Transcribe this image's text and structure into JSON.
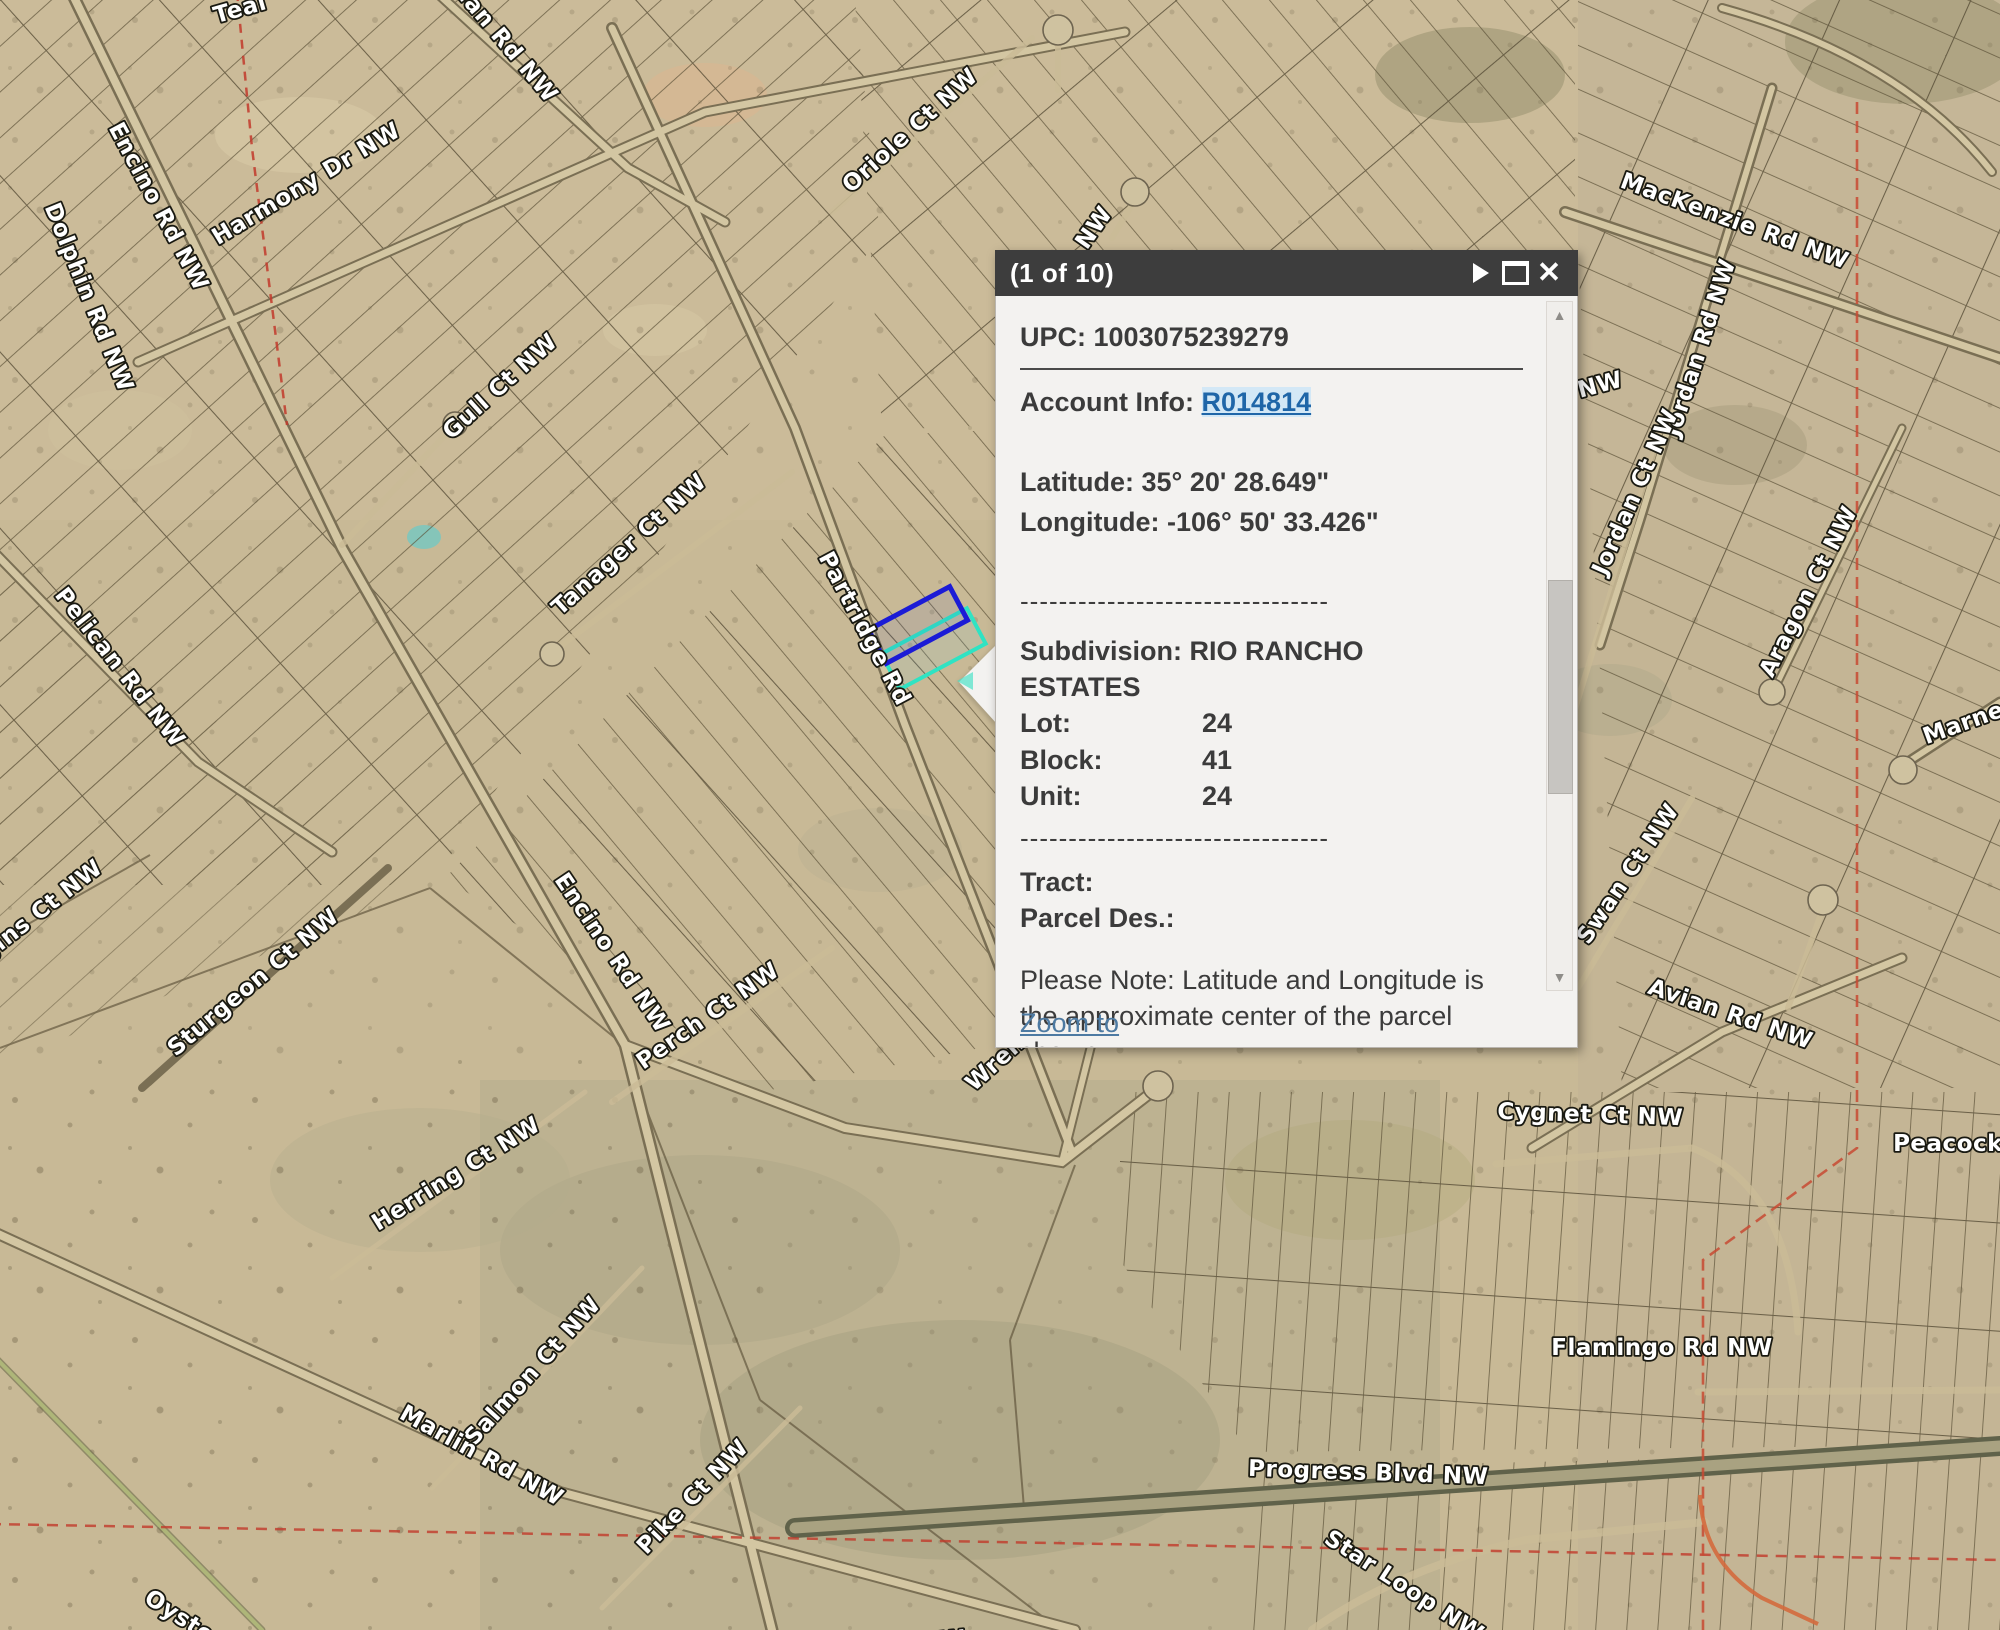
{
  "popup": {
    "title": "(1 of 10)",
    "icons": {
      "next_glyph": "▶",
      "close_glyph": "✕",
      "scroll_up_glyph": "▲",
      "scroll_down_glyph": "▼"
    },
    "fields": {
      "upc_label": "UPC:",
      "upc_value": "1003075239279",
      "account_label": "Account Info:",
      "account_link": "R014814",
      "latitude_label": "Latitude:",
      "latitude_value": "35° 20' 28.649\"",
      "longitude_label": "Longitude:",
      "longitude_value": "-106° 50' 33.426\"",
      "separator": "--------------------------------",
      "subdivision_label": "Subdivision:",
      "subdivision_value": "RIO RANCHO ESTATES",
      "lot_label": "Lot:",
      "lot_value": "24",
      "block_label": "Block:",
      "block_value": "41",
      "unit_label": "Unit:",
      "unit_value": "24",
      "separator2": "--------------------------------",
      "tract_label": "Tract:",
      "tract_value": "",
      "parcel_des_label": "Parcel Des.:",
      "parcel_des_value": "",
      "note": "Please Note: Latitude and Longitude is the approximate center of the parcel shown",
      "zoom_to": "Zoom to"
    },
    "colors": {
      "header_bg": "#3d3d3d",
      "body_bg": "#f3f2f0",
      "link": "#1f66a8"
    }
  },
  "map": {
    "selection": {
      "parcel_outline_blue": "#1b1bd6",
      "parcel_outline_teal": "#2fe3c3",
      "boundary_red": "#c2392b"
    },
    "labels": [
      {
        "text": "Teal",
        "x": 242,
        "y": 16,
        "rot": -16
      },
      {
        "text": "Avian Rd NW",
        "x": 492,
        "y": 38,
        "rot": 50
      },
      {
        "text": "Oriole Ct NW",
        "x": 915,
        "y": 136,
        "rot": -42
      },
      {
        "text": "NW",
        "x": 1100,
        "y": 232,
        "rot": -55
      },
      {
        "text": "Harmony Dr NW",
        "x": 310,
        "y": 190,
        "rot": -31
      },
      {
        "text": "Encino Rd NW",
        "x": 152,
        "y": 210,
        "rot": 62
      },
      {
        "text": "Dolphin Rd NW",
        "x": 82,
        "y": 300,
        "rot": 68
      },
      {
        "text": "MacKenzie Rd NW",
        "x": 1732,
        "y": 228,
        "rot": 20
      },
      {
        "text": "Jordan Rd NW",
        "x": 1707,
        "y": 350,
        "rot": -72
      },
      {
        "text": "Jordan Ct NW",
        "x": 1642,
        "y": 495,
        "rot": -66
      },
      {
        "text": "NW",
        "x": 1602,
        "y": 392,
        "rot": -15
      },
      {
        "text": "Aragon Ct NW",
        "x": 1815,
        "y": 595,
        "rot": -63
      },
      {
        "text": "Marne",
        "x": 1966,
        "y": 730,
        "rot": -20
      },
      {
        "text": "Gull Ct NW",
        "x": 505,
        "y": 392,
        "rot": -42
      },
      {
        "text": "Tanager Ct NW",
        "x": 634,
        "y": 550,
        "rot": -42
      },
      {
        "text": "Partridge Rd",
        "x": 858,
        "y": 632,
        "rot": 62
      },
      {
        "text": "Pelican Rd NW",
        "x": 114,
        "y": 672,
        "rot": 52
      },
      {
        "text": "Higgins Ct NW",
        "x": 28,
        "y": 930,
        "rot": -38
      },
      {
        "text": "Sturgeon Ct NW",
        "x": 258,
        "y": 988,
        "rot": -40
      },
      {
        "text": "Encino Rd NW",
        "x": 606,
        "y": 957,
        "rot": 56
      },
      {
        "text": "Perch Ct NW",
        "x": 712,
        "y": 1022,
        "rot": -35
      },
      {
        "text": "Wren Ct",
        "x": 1014,
        "y": 1056,
        "rot": -42
      },
      {
        "text": "Herring Ct NW",
        "x": 460,
        "y": 1180,
        "rot": -32
      },
      {
        "text": "Salmon Ct NW",
        "x": 538,
        "y": 1376,
        "rot": -48
      },
      {
        "text": "Marlin Rd NW",
        "x": 478,
        "y": 1462,
        "rot": 29
      },
      {
        "text": "Pike Ct NW",
        "x": 698,
        "y": 1502,
        "rot": -46
      },
      {
        "text": "Swan Ct NW",
        "x": 1634,
        "y": 878,
        "rot": -56
      },
      {
        "text": "Avian Rd NW",
        "x": 1728,
        "y": 1021,
        "rot": 19
      },
      {
        "text": "Cygnet Ct NW",
        "x": 1590,
        "y": 1122,
        "rot": 2
      },
      {
        "text": "Peacock",
        "x": 1948,
        "y": 1151,
        "rot": 0
      },
      {
        "text": "Flamingo Rd NW",
        "x": 1662,
        "y": 1355,
        "rot": 0
      },
      {
        "text": "Progress Blvd NW",
        "x": 1368,
        "y": 1480,
        "rot": 2
      },
      {
        "text": "Star Loop NW",
        "x": 1400,
        "y": 1592,
        "rot": 33
      },
      {
        "text": "Oyster Ct",
        "x": 196,
        "y": 1636,
        "rot": 33
      },
      {
        "text": "Ct NW",
        "x": 925,
        "y": 1650,
        "rot": -6
      }
    ]
  }
}
